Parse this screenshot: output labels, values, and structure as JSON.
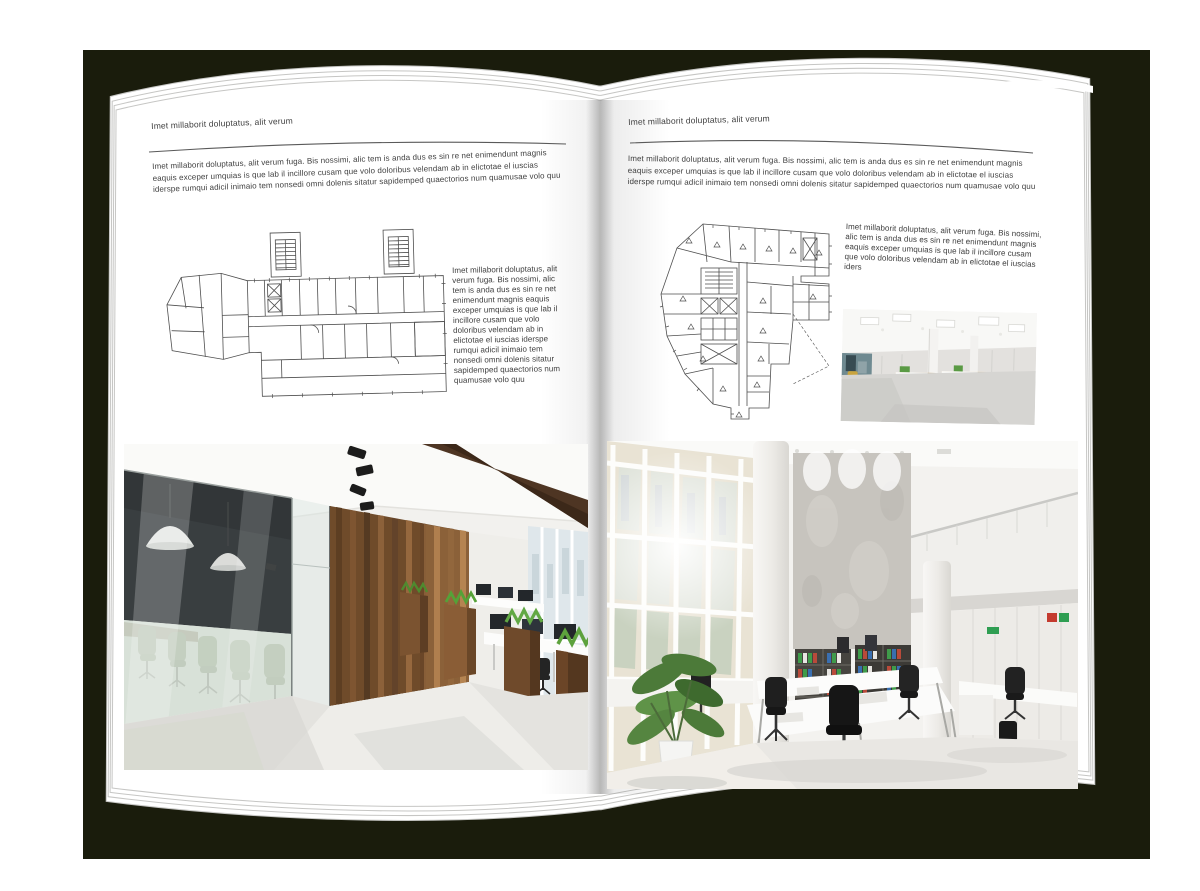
{
  "mockup": {
    "type": "open-magazine-spread",
    "colors": {
      "backdrop": "#1a1c0c",
      "page": "#ffffff",
      "text": "#3e3e3e",
      "rule": "#5a5a5a",
      "plan_line": "#4f4f4f",
      "wood_wall": "#6f4b2a",
      "meeting_glass_dark": "#191b1e",
      "chair_green": "#4b5e2f",
      "planter_grass": "#57a03c",
      "binder_green": "#3f9b4a",
      "binder_red": "#b94a3a",
      "binder_blue": "#3a6fb0",
      "concrete": "#c7c4be"
    }
  },
  "pages": {
    "left": {
      "header": "Imet millaborit doluptatus, alit verum",
      "intro": "Imet millaborit doluptatus, alit verum fuga. Bis nossimi, alic tem is anda dus es sin re net enimendunt magnis eaquis exceper umquias is que lab il incillore cusam que volo doloribus velendam ab in elictotae el iuscias iderspe rumqui adicil inimaio tem nonsedi omni dolenis sitatur sapidemped quaectorios num quamusae volo quu",
      "side_text": "Imet millaborit doluptatus, alit verum fuga. Bis nossimi, alic tem is anda dus es sin re net enimendunt magnis eaquis exceper umquias is que lab il incillore cusam que volo doloribus velendam ab in elictotae el iuscias iderspe rumqui adicil inimaio tem nonsedi omni dolenis sitatur sapidemped quaectorios num quamusae volo quu",
      "images": {
        "floor_plan": "architectural-floor-plan-wide-building",
        "photo": "loft-office-interior-wood-walls-green-chairs"
      }
    },
    "right": {
      "header": "Imet millaborit doluptatus, alit verum",
      "intro": "Imet millaborit doluptatus, alit verum fuga. Bis nossimi, alic tem is anda dus es sin re net enimendunt magnis eaquis exceper umquias is que lab il incillore cusam que volo doloribus velendam ab in elictotae el iuscias iderspe rumqui adicil inimaio tem nonsedi omni dolenis sitatur sapidemped quaectorios num quamusae volo quu",
      "side_text": "Imet millaborit doluptatus, alit verum fuga. Bis nossimi, alic tem is anda dus es sin re net enimendunt magnis eaquis exceper umquias is que lab il incillore cusam que volo doloribus velendam ab in elictotae el iuscias iders",
      "images": {
        "floor_plan": "architectural-floor-plan-irregular-building",
        "photo_small": "open-office-rows-of-desks",
        "photo": "bright-atrium-office-interior"
      }
    }
  }
}
